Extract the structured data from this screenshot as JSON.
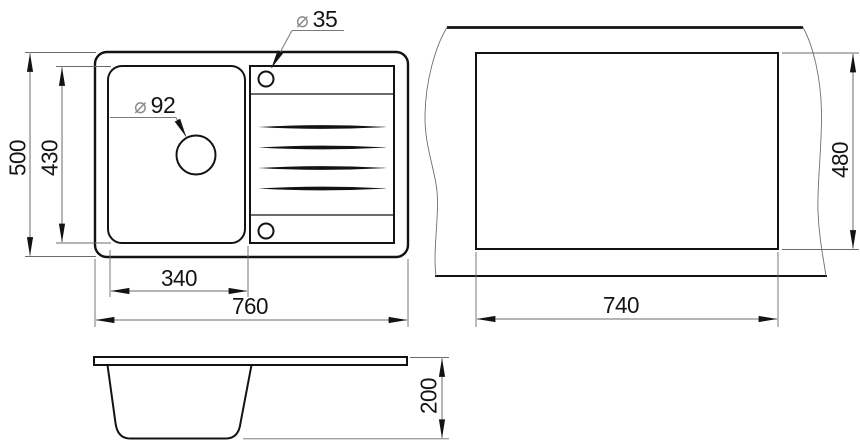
{
  "views": {
    "plan": {
      "outer_height": "500",
      "bowl_height": "430",
      "bowl_width": "340",
      "outer_width": "760",
      "drain_hole": {
        "symbol": "⌀",
        "value": "92"
      },
      "tap_hole": {
        "symbol": "⌀",
        "value": "35"
      }
    },
    "cutout": {
      "height": "480",
      "width": "740"
    },
    "profile": {
      "depth": "200"
    }
  },
  "colors": {
    "outline": "#131313",
    "dimension_line": "#6b6b6b",
    "diameter_symbol": "#8a8a8a",
    "text": "#141414",
    "background": "#ffffff"
  }
}
